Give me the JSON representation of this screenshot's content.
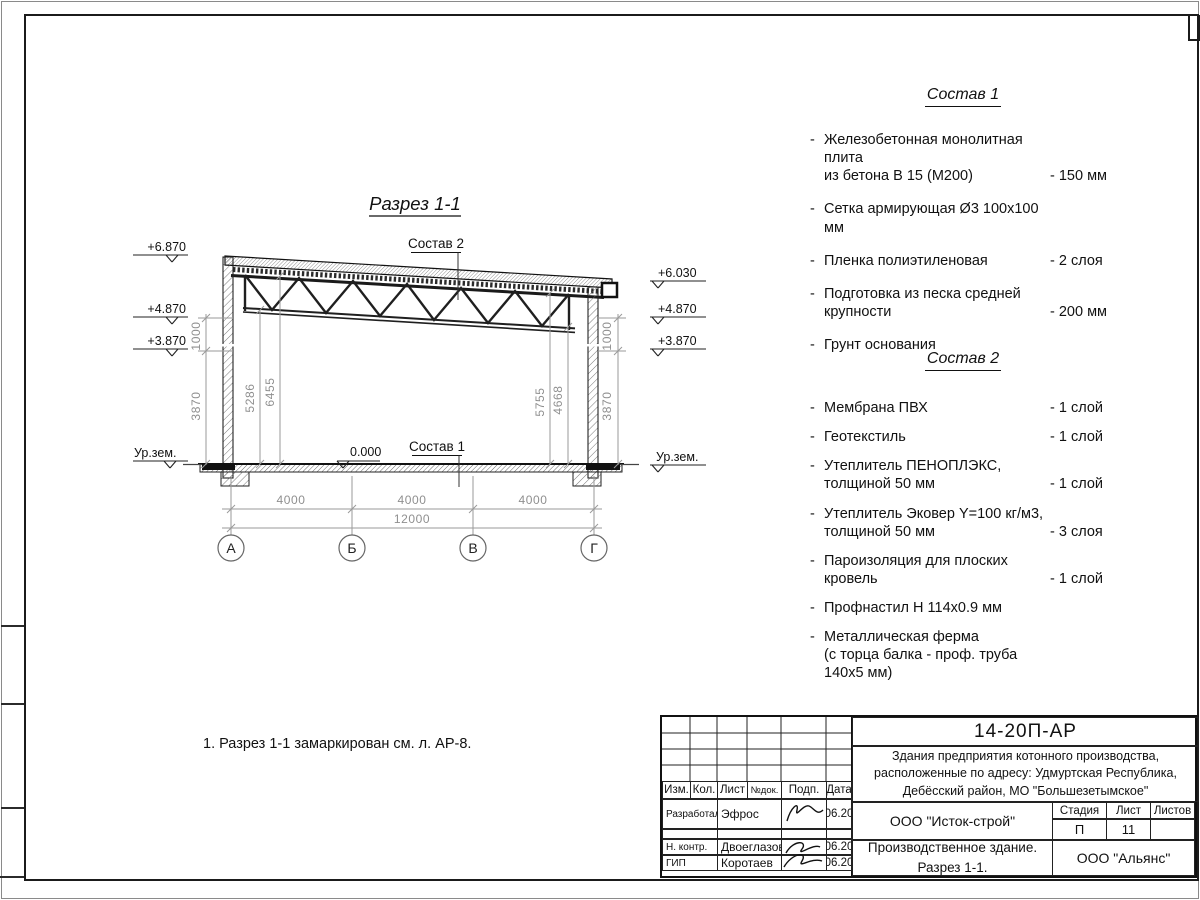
{
  "drawing": {
    "title": "Разрез 1-1",
    "sostav2_label": "Состав 2",
    "sostav1_label": "Состав 1",
    "zero_level": "0.000",
    "ur_zem": "Ур.зем.",
    "elev_left": [
      "+6.870",
      "+4.870",
      "+3.870"
    ],
    "elev_right": [
      "+6.030",
      "+4.870",
      "+3.870"
    ],
    "dims": {
      "left_1000": "1000",
      "left_3870": "3870",
      "right_1000": "1000",
      "right_3870": "3870",
      "d5286": "5286",
      "d6455": "6455",
      "d5755": "5755",
      "d4668": "4668",
      "spans": [
        "4000",
        "4000",
        "4000"
      ],
      "total": "12000"
    },
    "axes": [
      "А",
      "Б",
      "В",
      "Г"
    ],
    "note": "1. Разрез 1-1 замаркирован см. л. АР-8."
  },
  "lists": {
    "bullet": "-",
    "sostav1": {
      "title": "Состав 1",
      "items": [
        {
          "name": "Железобетонная  монолитная плита\nиз бетона В 15 (М200)",
          "value": "- 150 мм"
        },
        {
          "name": "Сетка армирующая Ø3 100х100 мм",
          "value": ""
        },
        {
          "name": "Пленка полиэтиленовая",
          "value": "-  2 слоя"
        },
        {
          "name": "Подготовка из песка средней\nкрупности",
          "value": "- 200 мм"
        },
        {
          "name": "Грунт основания",
          "value": ""
        }
      ]
    },
    "sostav2": {
      "title": "Состав 2",
      "items": [
        {
          "name": "Мембрана ПВХ",
          "value": "- 1 слой"
        },
        {
          "name": "Геотекстиль",
          "value": "- 1 слой"
        },
        {
          "name": "Утеплитель ПЕНОПЛЭКС,\nтолщиной 50 мм",
          "value": "- 1 слой"
        },
        {
          "name": "Утеплитель Эковер Y=100 кг/м3,\nтолщиной 50 мм",
          "value": "- 3 слоя"
        },
        {
          "name": "Пароизоляция для плоских кровель",
          "value": "- 1 слой"
        },
        {
          "name": "Профнастил Н 114х0.9 мм",
          "value": ""
        },
        {
          "name": "Металлическая ферма\n(с торца балка - проф. труба 140х5 мм)",
          "value": ""
        }
      ]
    }
  },
  "titleblock": {
    "doc_number": "14-20П-АР",
    "project": "Здания предприятия котонного производства,\nрасположенные по адресу: Удмуртская Республика,\nДебёсский район, МО \"Большезетымское\"",
    "columns": [
      "Изм.",
      "Кол.",
      "Лист",
      "№док.",
      "Подп.",
      "Дата"
    ],
    "sign_rows": [
      {
        "role": "Разработал",
        "name": "Эфрос",
        "date": "06.20"
      },
      {
        "role": "Н. контр.",
        "name": "Двоеглазов",
        "date": "06.20"
      },
      {
        "role": "ГИП",
        "name": "Коротаев",
        "date": "06.20"
      }
    ],
    "org1": "ООО \"Исток-строй\"",
    "stage_header": [
      "Стадия",
      "Лист",
      "Листов"
    ],
    "stage": "П",
    "sheet": "11",
    "sheets_total": "",
    "object": "Производственное здание.\nРазрез 1-1.",
    "org2": "ООО \"Альянс\""
  }
}
